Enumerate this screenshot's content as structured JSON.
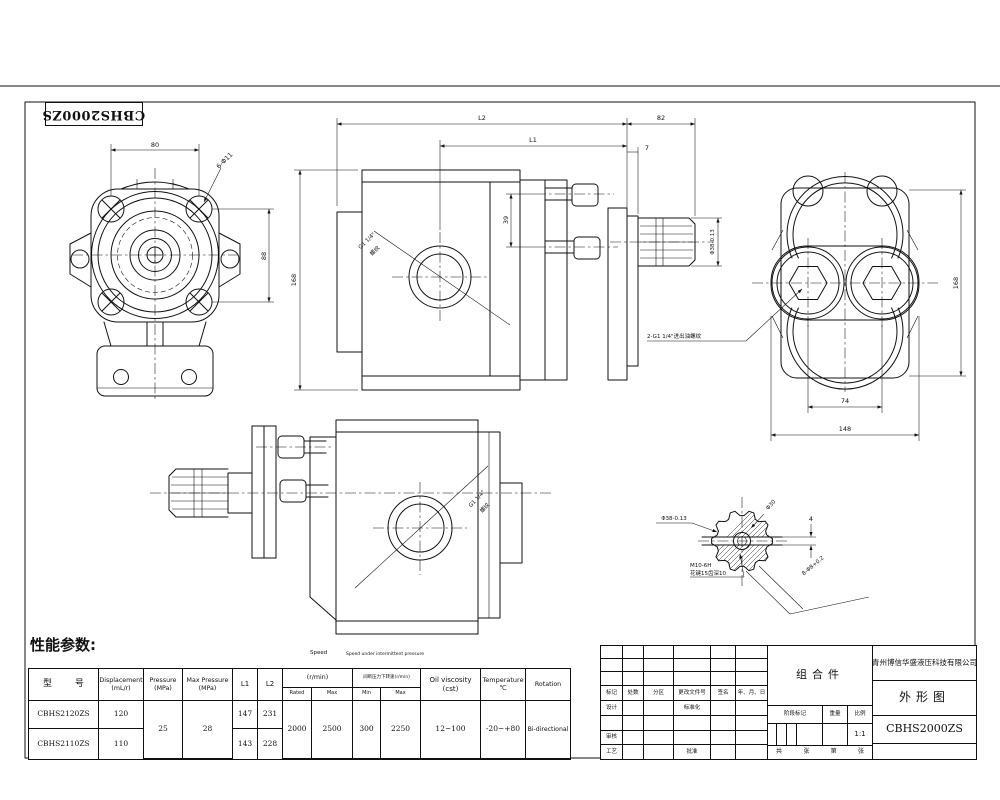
{
  "sheet": {
    "stamp": "CBHS2000ZS",
    "perf_heading": "性能参数:"
  },
  "views": {
    "front": {
      "dim_width": "80",
      "hole_label": "6-Φ11",
      "dim_height": "88"
    },
    "side": {
      "dim_l2": "L2",
      "dim_l1": "L1",
      "dim_shaft_len": "82",
      "dim_face": "7",
      "dim_height": "168",
      "dim_ports": "39",
      "dim_shaft_dia": "Φ38-0.13",
      "port_thread": "G1 1/4\"",
      "port_thread_cn": "螺纹"
    },
    "rear": {
      "dim_port_spacing": "74",
      "dim_width": "148",
      "dim_height": "168",
      "ports_label": "2-G1 1/4\"进出油螺纹"
    },
    "bottom_side": {
      "port_thread": "G1 1/4\"",
      "port_thread_cn": "螺纹"
    },
    "shaft_section": {
      "dim_major": "Φ38-0.13",
      "dim_minor": "Φ30",
      "dim_slot": "4",
      "thread_label": "M10-6H",
      "spline_label": "花键15齿深10",
      "tol_label": "8-Φ8+0.2"
    }
  },
  "perf_table": {
    "speed_float": "Speed",
    "int_float": "Speed under intermittent pressure",
    "h_model": "型        号",
    "h_disp1": "Displacement",
    "h_disp2": "(mL/r)",
    "h_press1": "Pressure",
    "h_press2": "(MPa)",
    "h_maxp1": "Max Pressure",
    "h_maxp2": "(MPa)",
    "h_l1": "L1",
    "h_l2": "L2",
    "h_speed_unit": "(r/min)",
    "h_rated": "Rated",
    "h_max": "Max",
    "h_int": "间断压力下转速(r/min)",
    "h_min": "Min",
    "h_imax": "Max",
    "h_visc1": "Oil viscosity",
    "h_visc2": "(cst)",
    "h_temp1": "Temperature",
    "h_temp2": "℃",
    "h_rot": "Rotation",
    "rows": [
      {
        "model": "CBHS2120ZS",
        "disp": "120",
        "l1": "147",
        "l2": "231"
      },
      {
        "model": "CBHS2110ZS",
        "disp": "110",
        "l1": "143",
        "l2": "228"
      }
    ],
    "shared": {
      "pressure": "25",
      "max_pressure": "28",
      "rated": "2000",
      "max": "2500",
      "min": "300",
      "imax": "2250",
      "visc": "12~100",
      "temp": "-20~+80",
      "rotation": "Bi-directional"
    }
  },
  "title_block": {
    "assembly": "组合件",
    "company": "青州博信华盛液压科技有限公司",
    "drawing_name": "外形图",
    "model": "CBHS2000ZS",
    "rev": [
      "标记",
      "处数",
      "分区",
      "更改文件号",
      "签名",
      "年、月、日"
    ],
    "design": "设计",
    "standardize": "标准化",
    "check": "审核",
    "process": "工艺",
    "approve": "批准",
    "stage": "阶段标记",
    "weight": "重量",
    "scale": "比例",
    "scale_val": "1:1",
    "sheet_total_1": "共",
    "sheet_total_2": "张",
    "sheet_no_1": "第",
    "sheet_no_2": "张"
  }
}
